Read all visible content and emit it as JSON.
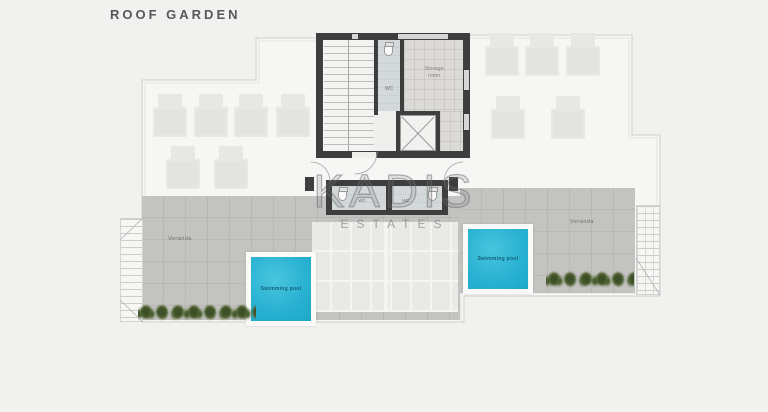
{
  "header": {
    "title": "ROOF GARDEN"
  },
  "watermark": {
    "brand": "KADIS",
    "subtitle": "ESTATES"
  },
  "plan": {
    "labels": {
      "veranda_left": "Veranda",
      "veranda_right": "Veranda",
      "pool_left": "Swimming pool",
      "pool_right": "Swimming pool",
      "wc_core": "WC",
      "wc_annex_left": "WC",
      "wc_annex_right": "WC",
      "storage_line1": "Storage",
      "storage_line2": "room"
    },
    "colors": {
      "pool": "#1fa7ca",
      "wall": "#3e3e3e",
      "veranda": "#c3c3c1",
      "plants": "#4c5f33",
      "outline": "#d0d0ce"
    }
  }
}
